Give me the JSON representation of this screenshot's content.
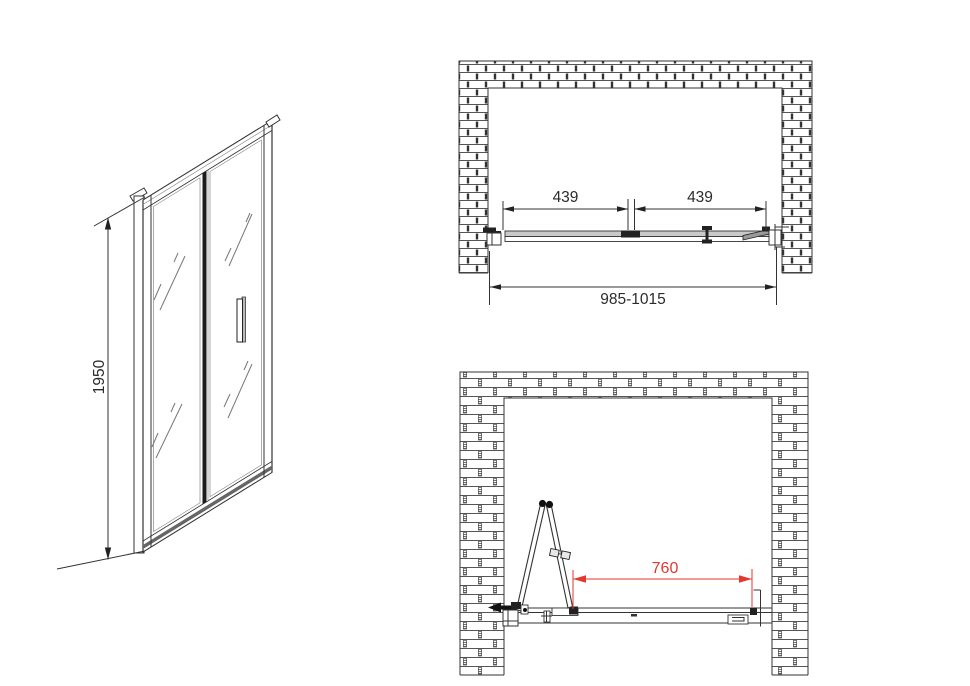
{
  "drawing": {
    "front_view": {
      "height_label": "1950"
    },
    "plan_view_closed": {
      "left_segment_label": "439",
      "right_segment_label": "439",
      "overall_width_label": "985-1015"
    },
    "plan_view_open": {
      "clear_opening_label": "760"
    },
    "colors": {
      "line_black": "#333333",
      "rail_gray": "#c9c9c9",
      "dimension_red": "#e4372e",
      "background": "#ffffff"
    }
  }
}
